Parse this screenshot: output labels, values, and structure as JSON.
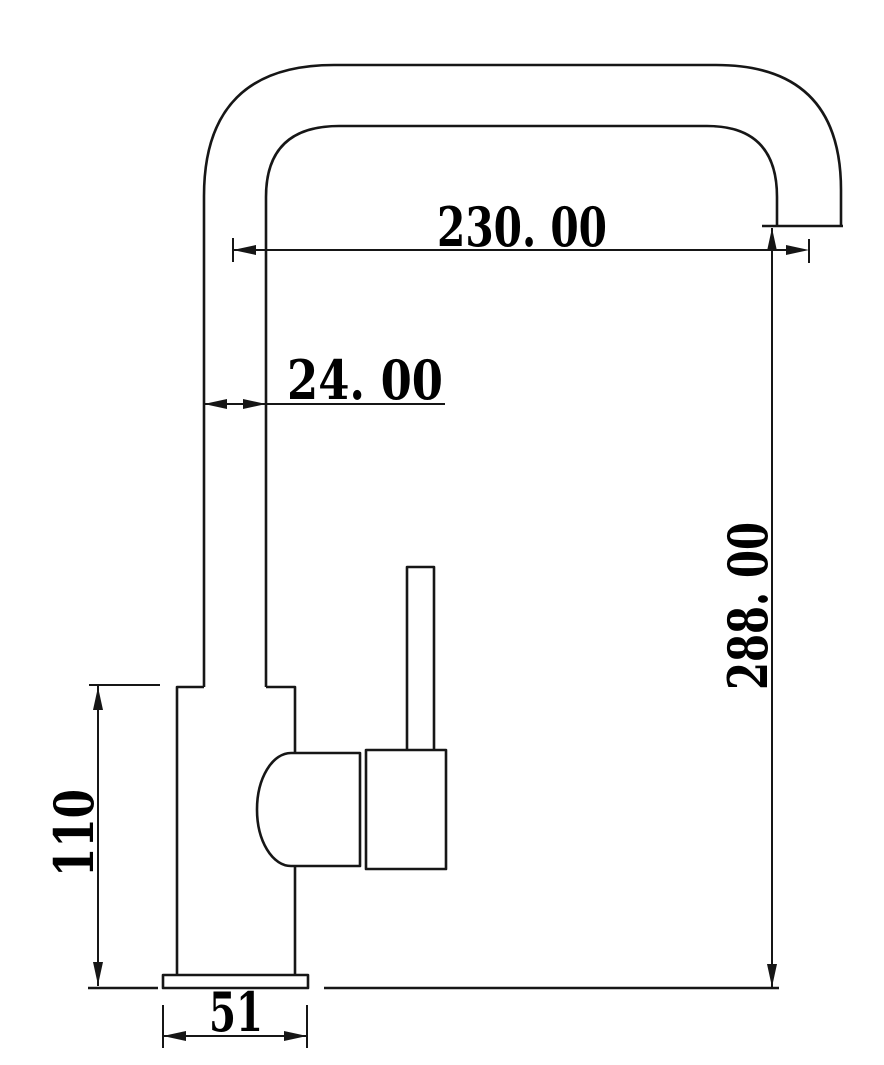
{
  "colors": {
    "line": "#161616",
    "text": "#000000",
    "background": "#ffffff"
  },
  "dimensions": {
    "spout_reach": "230. 00",
    "spout_pipe_width": "24. 00",
    "spout_height": "288. 00",
    "body_height": "110",
    "base_width": "51"
  }
}
